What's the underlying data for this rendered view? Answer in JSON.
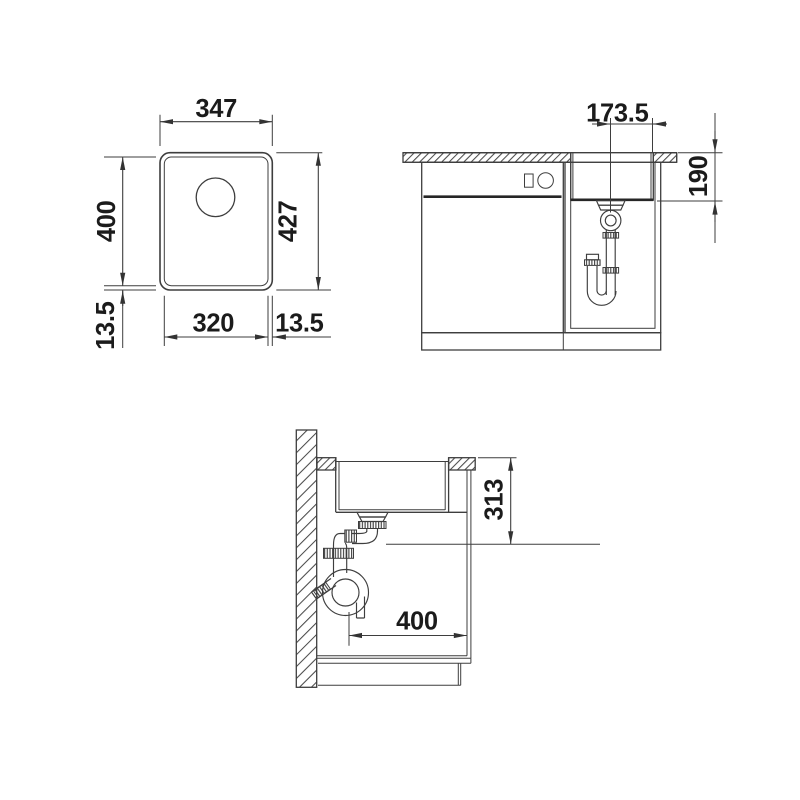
{
  "colors": {
    "line": "#3e3e3e",
    "text": "#1b1b1b",
    "background": "#ffffff"
  },
  "plan_view": {
    "width_outer": "347",
    "length_inner": "400",
    "length_outer": "427",
    "width_inner": "320",
    "offset_bottom_left": "13.5",
    "offset_bottom_right": "13.5"
  },
  "front_view": {
    "center_to_edge": "173.5",
    "bowl_depth": "190"
  },
  "side_view": {
    "installation_depth": "313",
    "trap_offset": "400"
  }
}
